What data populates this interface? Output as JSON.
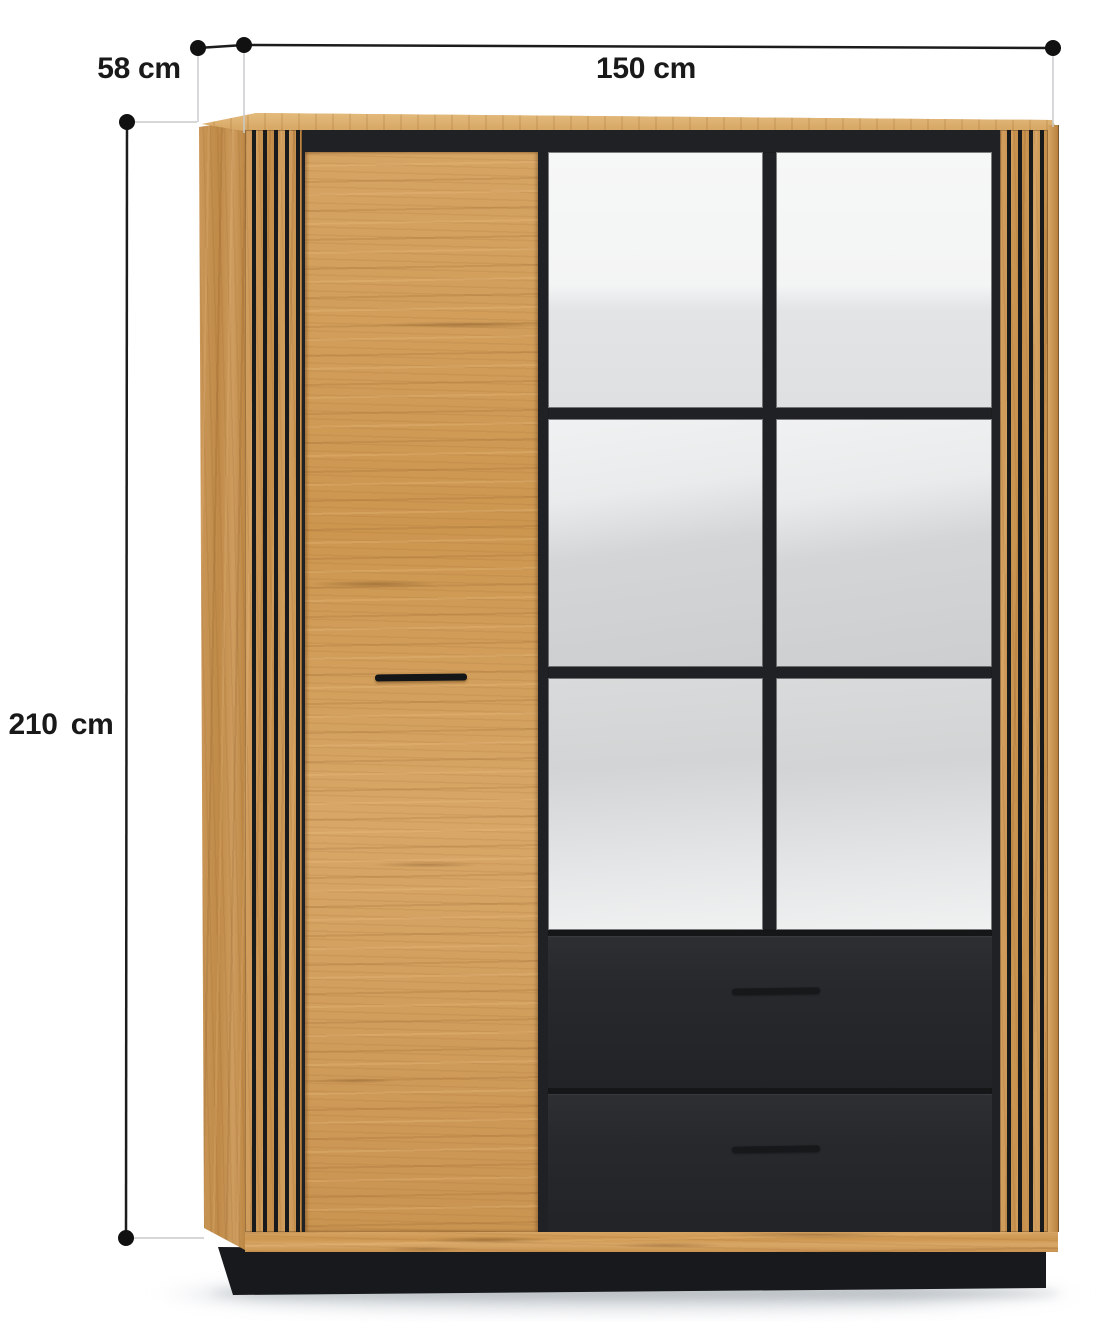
{
  "diagram": {
    "product": "display cabinet with slat panels, glass doors and drawers",
    "dimensions": {
      "width": {
        "label": "150 cm",
        "value": 150,
        "unit": "cm"
      },
      "depth": {
        "label": "58 cm",
        "value": 58,
        "unit": "cm"
      },
      "height": {
        "label": "210 cm",
        "value": 210,
        "unit": "cm"
      }
    },
    "colors": {
      "background": "#ffffff",
      "oak_wood": "#cf9a57",
      "black_accent": "#1f2124",
      "glass": "#e8eaeb",
      "dimension_line": "#1c1c1c",
      "extension_line": "#c9cbcc",
      "dimension_dot": "#111111"
    }
  }
}
